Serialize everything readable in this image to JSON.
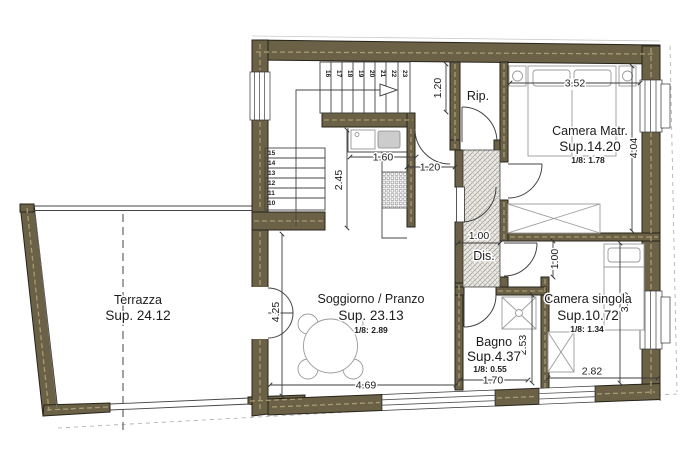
{
  "colors": {
    "wall": "#6B6147",
    "wall_outline": "#26231A",
    "wall_centerline": "#A89A74",
    "line": "#3C3C3C",
    "hatch": "#9A9890"
  },
  "rooms": {
    "terrazza": {
      "name": "Terrazza",
      "sup": "Sup. 24.12"
    },
    "soggiorno": {
      "name": "Soggiorno / Pranzo",
      "sup": "Sup. 23.13",
      "ratio": "1/8: 2.89"
    },
    "camera_matr": {
      "name": "Camera Matr.",
      "sup": "Sup.14.20",
      "ratio": "1/8: 1.78"
    },
    "camera_singola": {
      "name": "Camera singola",
      "sup": "Sup.10.72",
      "ratio": "1/8: 1.34"
    },
    "bagno": {
      "name": "Bagno",
      "sup": "Sup.4.37",
      "ratio": "1/8: 0.55"
    },
    "rip": {
      "name": "Rip."
    },
    "dis": {
      "name": "Dis."
    }
  },
  "dimensions": {
    "matr_width": "3.52",
    "matr_height": "4.04",
    "singola_width": "2.82",
    "singola_height": "3.49",
    "singola_door": "1.00",
    "bagno_width": "1.70",
    "bagno_height": "2.53",
    "sogg_width": "4.69",
    "sogg_height": "4.25",
    "kitchen_width": "1.60",
    "kitchen_height": "2.45",
    "passage_width": "1.20",
    "stair_corridor": "1.20",
    "dis_width": "1.00"
  },
  "stairs": {
    "lower": [
      "15",
      "14",
      "13",
      "12",
      "11",
      "10"
    ],
    "upper": [
      "16",
      "17",
      "18",
      "19",
      "20",
      "21",
      "22",
      "23"
    ]
  }
}
